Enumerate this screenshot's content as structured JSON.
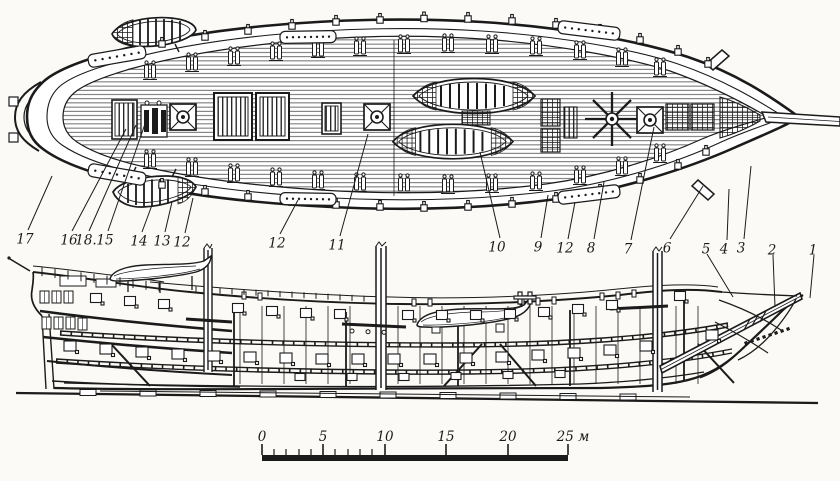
{
  "figure": {
    "kind": "ship-technical-drawing",
    "top_view": "deck-plan",
    "bottom_view": "side-elevation",
    "ink_color": "#1b1b1b",
    "paper_color": "#fbfaf6"
  },
  "callouts": [
    {
      "text": "17",
      "x": 25,
      "y": 239,
      "ax": 52,
      "ay": 176
    },
    {
      "text": "16",
      "x": 69,
      "y": 240,
      "ax": 126,
      "ay": 129
    },
    {
      "text": "18.",
      "x": 86,
      "y": 240,
      "ax": 136,
      "ay": 125
    },
    {
      "text": "15",
      "x": 105,
      "y": 240,
      "ax": 146,
      "ay": 121
    },
    {
      "text": "14",
      "x": 139,
      "y": 241,
      "ax": 152,
      "ay": 205
    },
    {
      "text": "13",
      "x": 162,
      "y": 241,
      "ax": 172,
      "ay": 202
    },
    {
      "text": "12",
      "x": 182,
      "y": 242,
      "ax": 193,
      "ay": 198
    },
    {
      "text": "12",
      "x": 277,
      "y": 243,
      "ax": 298,
      "ay": 200
    },
    {
      "text": "11",
      "x": 337,
      "y": 245,
      "ax": 368,
      "ay": 134
    },
    {
      "text": "10",
      "x": 497,
      "y": 247,
      "ax": 480,
      "ay": 152
    },
    {
      "text": "9",
      "x": 538,
      "y": 247,
      "ax": 548,
      "ay": 195
    },
    {
      "text": "12",
      "x": 565,
      "y": 248,
      "ax": 575,
      "ay": 202
    },
    {
      "text": "8",
      "x": 591,
      "y": 248,
      "ax": 604,
      "ay": 182
    },
    {
      "text": "7",
      "x": 628,
      "y": 249,
      "ax": 654,
      "ay": 127
    },
    {
      "text": "6",
      "x": 667,
      "y": 248,
      "ax": 703,
      "ay": 186
    },
    {
      "text": "5",
      "x": 706,
      "y": 249,
      "ax": 733,
      "ay": 297
    },
    {
      "text": "4",
      "x": 724,
      "y": 249,
      "ax": 729,
      "ay": 189
    },
    {
      "text": "3",
      "x": 741,
      "y": 248,
      "ax": 751,
      "ay": 166
    },
    {
      "text": "2",
      "x": 772,
      "y": 250,
      "ax": 775,
      "ay": 307
    },
    {
      "text": "1",
      "x": 813,
      "y": 250,
      "ax": 810,
      "ay": 298
    }
  ],
  "scale_bar": {
    "x_start": 262,
    "x_end": 568,
    "bar_top": 455,
    "bar_bottom": 461,
    "unit": "м",
    "major_ticks": [
      {
        "label": "0",
        "x": 262
      },
      {
        "label": "5",
        "x": 323
      },
      {
        "label": "10",
        "x": 385
      },
      {
        "label": "15",
        "x": 446
      },
      {
        "label": "20",
        "x": 508
      },
      {
        "label": "25 м",
        "x": 568,
        "label_x": 573
      }
    ],
    "minor_ticks": [
      274,
      286,
      299,
      311,
      335,
      348,
      360,
      372
    ]
  }
}
